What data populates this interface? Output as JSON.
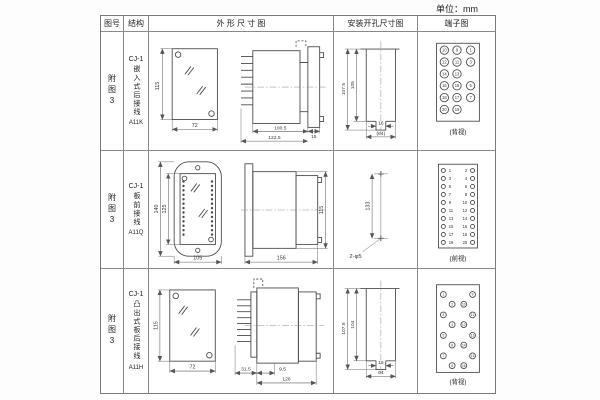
{
  "page": {
    "unit": "单位：mm"
  },
  "headers": {
    "fig": "图号",
    "structure": "结构",
    "outline": "外 形 尺 寸 图",
    "install": "安装开孔尺寸图",
    "terminal": "端子图"
  },
  "rows": [
    {
      "fig": "附图3",
      "model": "CJ-1",
      "mount": "嵌入式后接线",
      "code": "A11K",
      "outline": {
        "h": "115",
        "w": "72",
        "depth": "100.5",
        "total": "122.5",
        "flange": "15"
      },
      "install": {
        "outer": "107.5",
        "inner": "105",
        "notch": "16",
        "width": "(64)"
      },
      "terminal": {
        "view": "(背视)",
        "grid": [
          [
            "10",
            "9",
            "1"
          ],
          [
            "12",
            "11",
            "3"
          ],
          [
            "14",
            "13",
            ""
          ],
          [
            "16",
            "15",
            "5"
          ],
          [
            "18",
            "17",
            "7"
          ],
          [
            "20",
            "19",
            ""
          ]
        ]
      }
    },
    {
      "fig": "附图3",
      "model": "CJ-1",
      "mount": "板前接线",
      "code": "A11Q",
      "outline": {
        "outer_h": "140",
        "inner_h": "125",
        "w": "105",
        "len": "156",
        "side_h": "115"
      },
      "install": {
        "spacing": "133",
        "holes": "2-φ5"
      },
      "terminal": {
        "view": "(前视)",
        "left": [
          "1",
          "3",
          "5",
          "7",
          "9",
          "11",
          "13",
          "15",
          "17",
          "19"
        ],
        "right": [
          "2",
          "4",
          "6",
          "8",
          "10",
          "12",
          "14",
          "16",
          "18",
          "20"
        ]
      }
    },
    {
      "fig": "附图3",
      "model": "CJ-1",
      "mount": "凸出式板后接线",
      "code": "A11H",
      "outline": {
        "h": "115",
        "w": "72",
        "a": "31.5",
        "b": "9.5",
        "total": "126"
      },
      "install": {
        "outer": "107.5",
        "inner": "104",
        "notch": "16",
        "width": "64"
      },
      "terminal": {
        "view": "(背视)",
        "left_outer": [
          "1",
          "3",
          "5",
          "7"
        ],
        "left_inner": [
          "2",
          "4",
          "6",
          "8"
        ],
        "right_inner": [
          "10",
          "12",
          "14",
          "16"
        ],
        "right_outer": [
          "9",
          "11",
          "13",
          "15"
        ]
      }
    }
  ]
}
